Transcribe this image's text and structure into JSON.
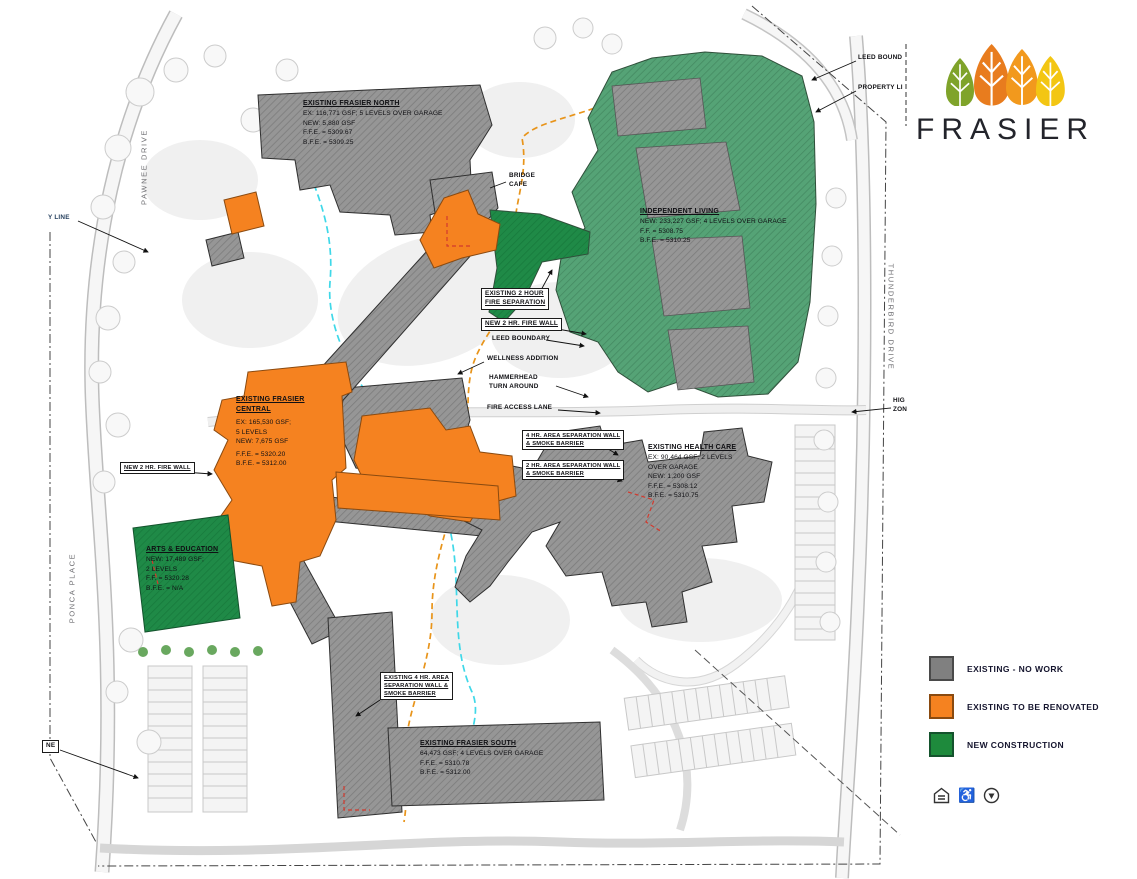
{
  "logo": {
    "wordmark": "FRASIER",
    "leaf_colors": [
      "#7fa32a",
      "#e87c1e",
      "#f2991d",
      "#f3c613"
    ]
  },
  "legend": {
    "items": [
      {
        "label": "EXISTING - NO WORK",
        "color": "#808080"
      },
      {
        "label": "EXISTING  TO BE RENOVATED",
        "color": "#F58220"
      },
      {
        "label": "NEW CONSTRUCTION",
        "color": "#1E8A3C"
      }
    ]
  },
  "streets": {
    "pawnee": "PAWNEE DRIVE",
    "ponca": "PONCA PLACE",
    "thunderbird": "THUNDERBIRD DRIVE"
  },
  "buildings": {
    "north": {
      "title": "EXISTING FRASIER NORTH",
      "lines": [
        "EX: 116,771 GSF; 5 LEVELS OVER GARAGE",
        "NEW: 5,880 GSF",
        "F.F.E. = 5309.67",
        "B.F.E. = 5309.25"
      ]
    },
    "independent_living": {
      "title": "INDEPENDENT LIVING",
      "lines": [
        "NEW: 233,227 GSF; 4 LEVELS OVER GARAGE",
        "F.F. = 5308.75",
        "B.F.E. = 5310.25"
      ]
    },
    "central": {
      "title": "EXISTING FRASIER CENTRAL",
      "lines": [
        "EX: 165,530 GSF;",
        "5 LEVELS",
        "NEW: 7,675 GSF",
        "F.F.E. = 5320.20",
        "B.F.E. = 5312.00"
      ]
    },
    "arts": {
      "title": "ARTS & EDUCATION",
      "lines": [
        "NEW: 17,489 GSF;",
        "2 LEVELS",
        "F.F. = 5320.28",
        "B.F.E. = N/A"
      ]
    },
    "health": {
      "title": "EXISTING HEALTH CARE",
      "lines": [
        "EX: 90,464 GSF; 2 LEVELS",
        "OVER GARAGE",
        "NEW: 1,200 GSF",
        "F.F.E. = 5308.12",
        "B.F.E. = 5310.75"
      ]
    },
    "south": {
      "title": "EXISTING FRASIER SOUTH",
      "lines": [
        "64,473 GSF; 4 LEVELS OVER GARAGE",
        "F.F.E. = 5310.78",
        "B.F.E. = 5312.00"
      ]
    }
  },
  "callouts": {
    "leed_bound": "LEED BOUND",
    "property_line_right": "PROPERTY LI",
    "property_line_left": "Y LINE",
    "bridge_1": "BRIDGE",
    "bridge_2": "CAFE",
    "fire_sep_1": "EXISTING 2 HOUR",
    "fire_sep_2": "FIRE SEPARATION",
    "new_fire_wall_mid": "NEW 2 HR. FIRE WALL",
    "new_fire_wall_left": "NEW 2 HR. FIRE WALL",
    "leed_boundary": "LEED BOUNDARY",
    "wellness": "WELLNESS ADDITION",
    "hammerhead_1": "HAMMERHEAD",
    "hammerhead_2": "TURN AROUND",
    "fire_access": "FIRE ACCESS LANE",
    "sep4_1": "4 HR. AREA SEPARATION WALL",
    "sep4_2": "& SMOKE BARRIER",
    "sep2_1": "2 HR. AREA SEPARATION WALL",
    "sep2_2": "& SMOKE BARRIER",
    "exist4_1": "EXISTING 4 HR. AREA",
    "exist4_2": "SEPARATION WALL &",
    "exist4_3": "SMOKE BARRIER",
    "high_zone_1": "HIG",
    "high_zone_2": "ZON",
    "ne": "NE"
  },
  "icons": {
    "accessibility_glyph": "♿"
  },
  "colors": {
    "existing_gray": "#969696",
    "renovate_orange": "#F58220",
    "new_green": "#1E8A3C",
    "il_green": "#55a376",
    "creek": "#3FD8E8",
    "leed_dash": "#E8941A",
    "red_dash": "#D23A2E"
  }
}
